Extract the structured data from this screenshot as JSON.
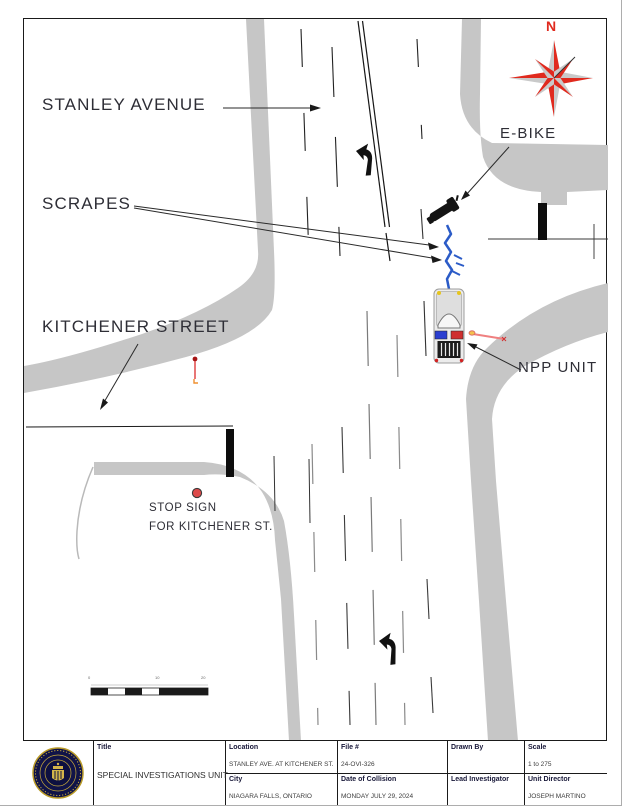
{
  "drawing": {
    "annotations": {
      "north": "N",
      "stanley_avenue": "STANLEY AVENUE",
      "scrapes": "SCRAPES",
      "kitchener_street": "KITCHENER STREET",
      "ebike": "E-BIKE",
      "npp_unit": "NPP UNIT",
      "stop_sign_line1": "STOP SIGN",
      "stop_sign_line2": "FOR KITCHENER ST."
    },
    "scale_bar": {
      "ticks": [
        "0",
        "10",
        "20"
      ]
    },
    "colors": {
      "road_gray": "#c6c6c6",
      "compass_red": "#e02a1e",
      "path_blue": "#2b5bc7",
      "lightbar_blue": "#2b3fd0",
      "lightbar_red": "#cf2f2f",
      "scrape_pink": "#ef8080",
      "seal_navy": "#101348",
      "seal_gold": "#c9ab3a"
    }
  },
  "title_block": {
    "title_label": "Title",
    "title_value": "SPECIAL INVESTIGATIONS UNIT",
    "location_label": "Location",
    "location_value": "STANLEY AVE. AT KITCHENER ST.",
    "file_label": "File #",
    "file_value": "24-OVI-326",
    "drawn_by_label": "Drawn By",
    "drawn_by_value": "",
    "scale_label": "Scale",
    "scale_value": "1 to 275",
    "city_label": "City",
    "city_value": "NIAGARA FALLS, ONTARIO",
    "date_label": "Date of Collision",
    "date_value": "MONDAY JULY 29, 2024",
    "lead_label": "Lead Investigator",
    "lead_value": "",
    "director_label": "Unit Director",
    "director_value": "JOSEPH MARTINO"
  }
}
